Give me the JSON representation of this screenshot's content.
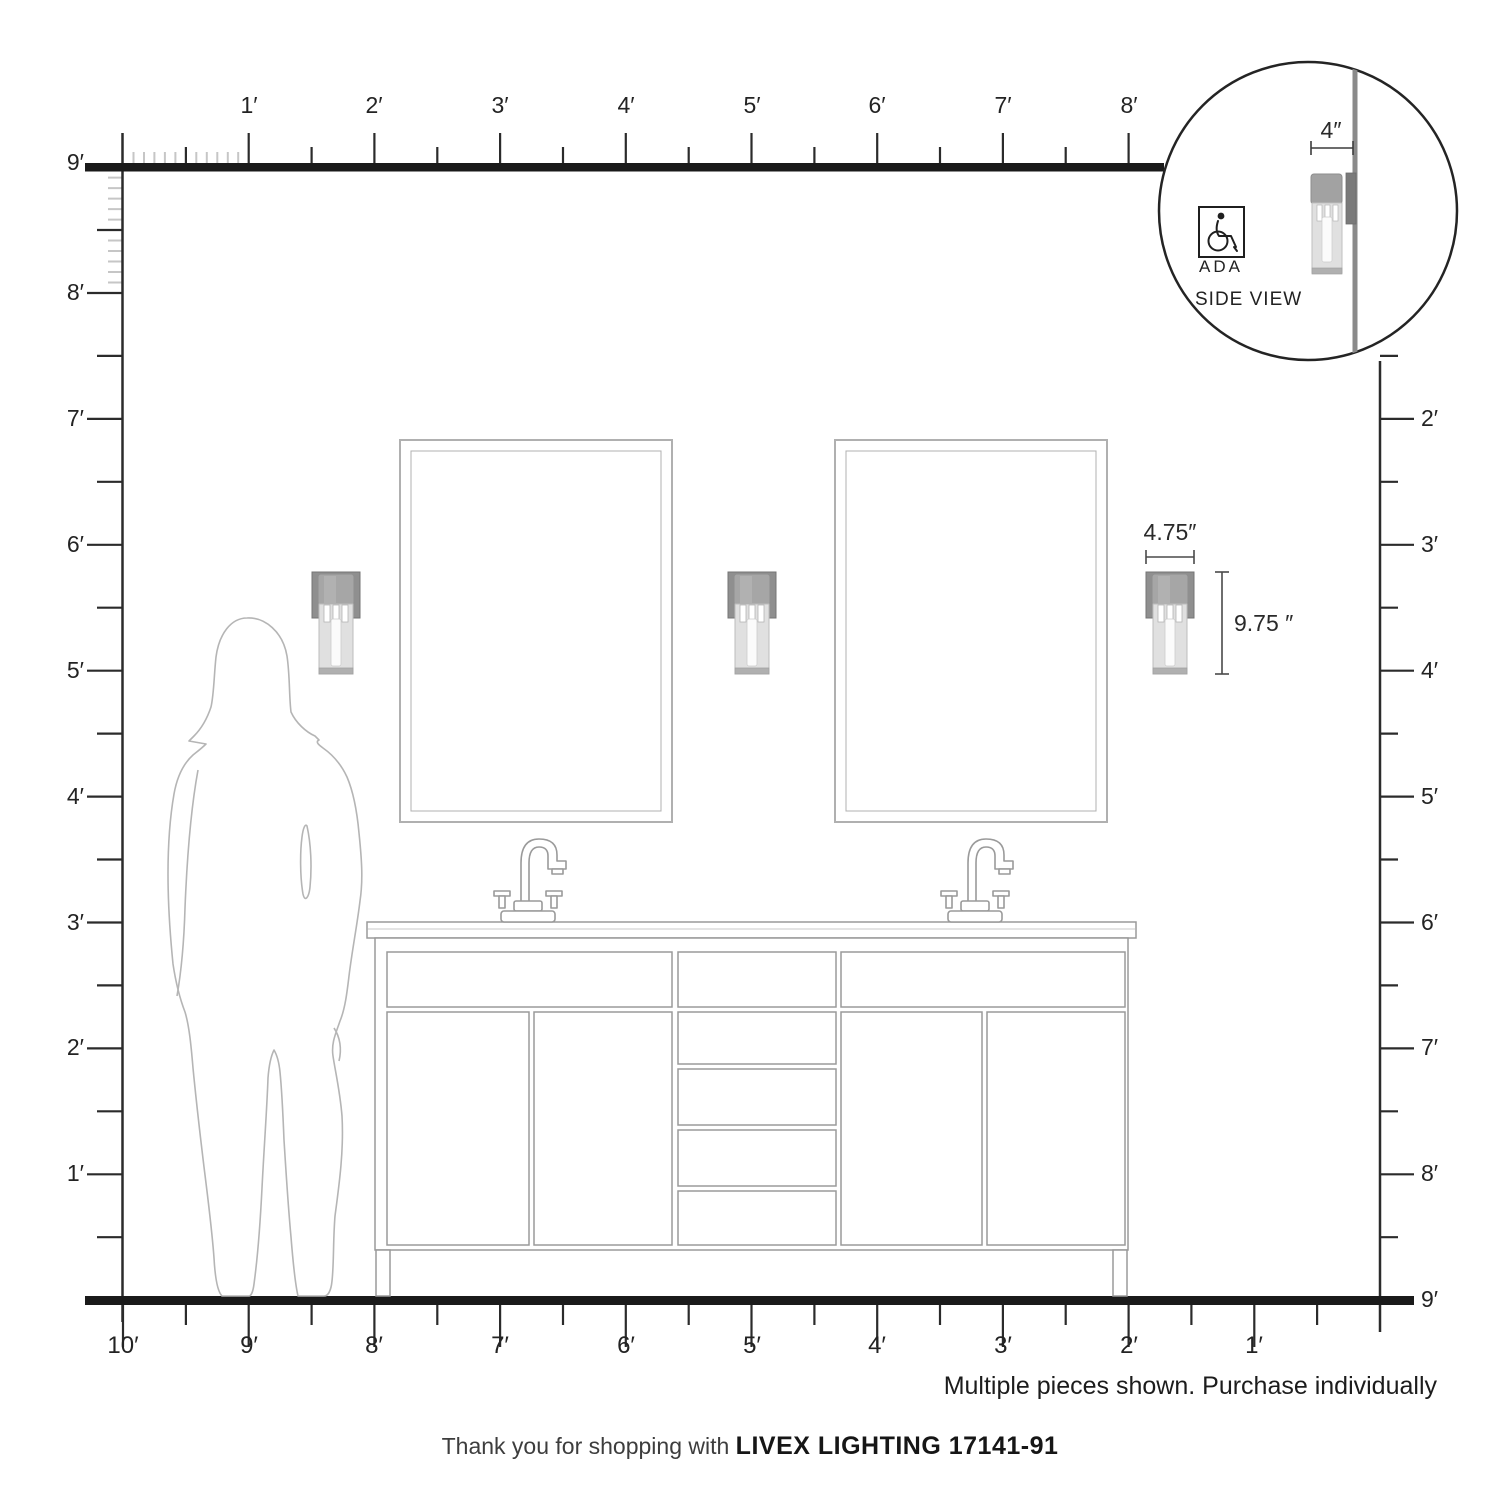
{
  "footer": {
    "thanks_prefix": "Thank you for shopping with",
    "brand_product": "LIVEX LIGHTING 17141-91"
  },
  "note": {
    "purchase": "Multiple pieces shown. Purchase individually"
  },
  "inset": {
    "ada_label": "ADA",
    "side_view_label": "SIDE VIEW",
    "depth_dim": "4″"
  },
  "fixture_dimensions": {
    "width": "4.75″",
    "height": "9.75 ″"
  },
  "rulers": {
    "top": [
      "1′",
      "2′",
      "3′",
      "4′",
      "5′",
      "6′",
      "7′",
      "8′"
    ],
    "left": [
      "9′",
      "8′",
      "7′",
      "6′",
      "5′",
      "4′",
      "3′",
      "2′",
      "1′"
    ],
    "right": [
      "2′",
      "3′",
      "4′",
      "5′",
      "6′",
      "7′",
      "8′",
      "9′"
    ],
    "bottom": [
      "10′",
      "9′",
      "8′",
      "7′",
      "6′",
      "5′",
      "4′",
      "3′",
      "2′",
      "1′"
    ]
  },
  "colors": {
    "bar_dark": "#1a1a1a",
    "ruler_tick": "#2b2b2b",
    "inch_tick": "#c6c6c6",
    "furniture_line": "#9a9a9a",
    "sconce_backplate": "#8f8f8f",
    "sconce_cap": "#a6a6a6",
    "sconce_glass": "#e0e0e0",
    "silhouette_line": "#b5b5b5"
  }
}
